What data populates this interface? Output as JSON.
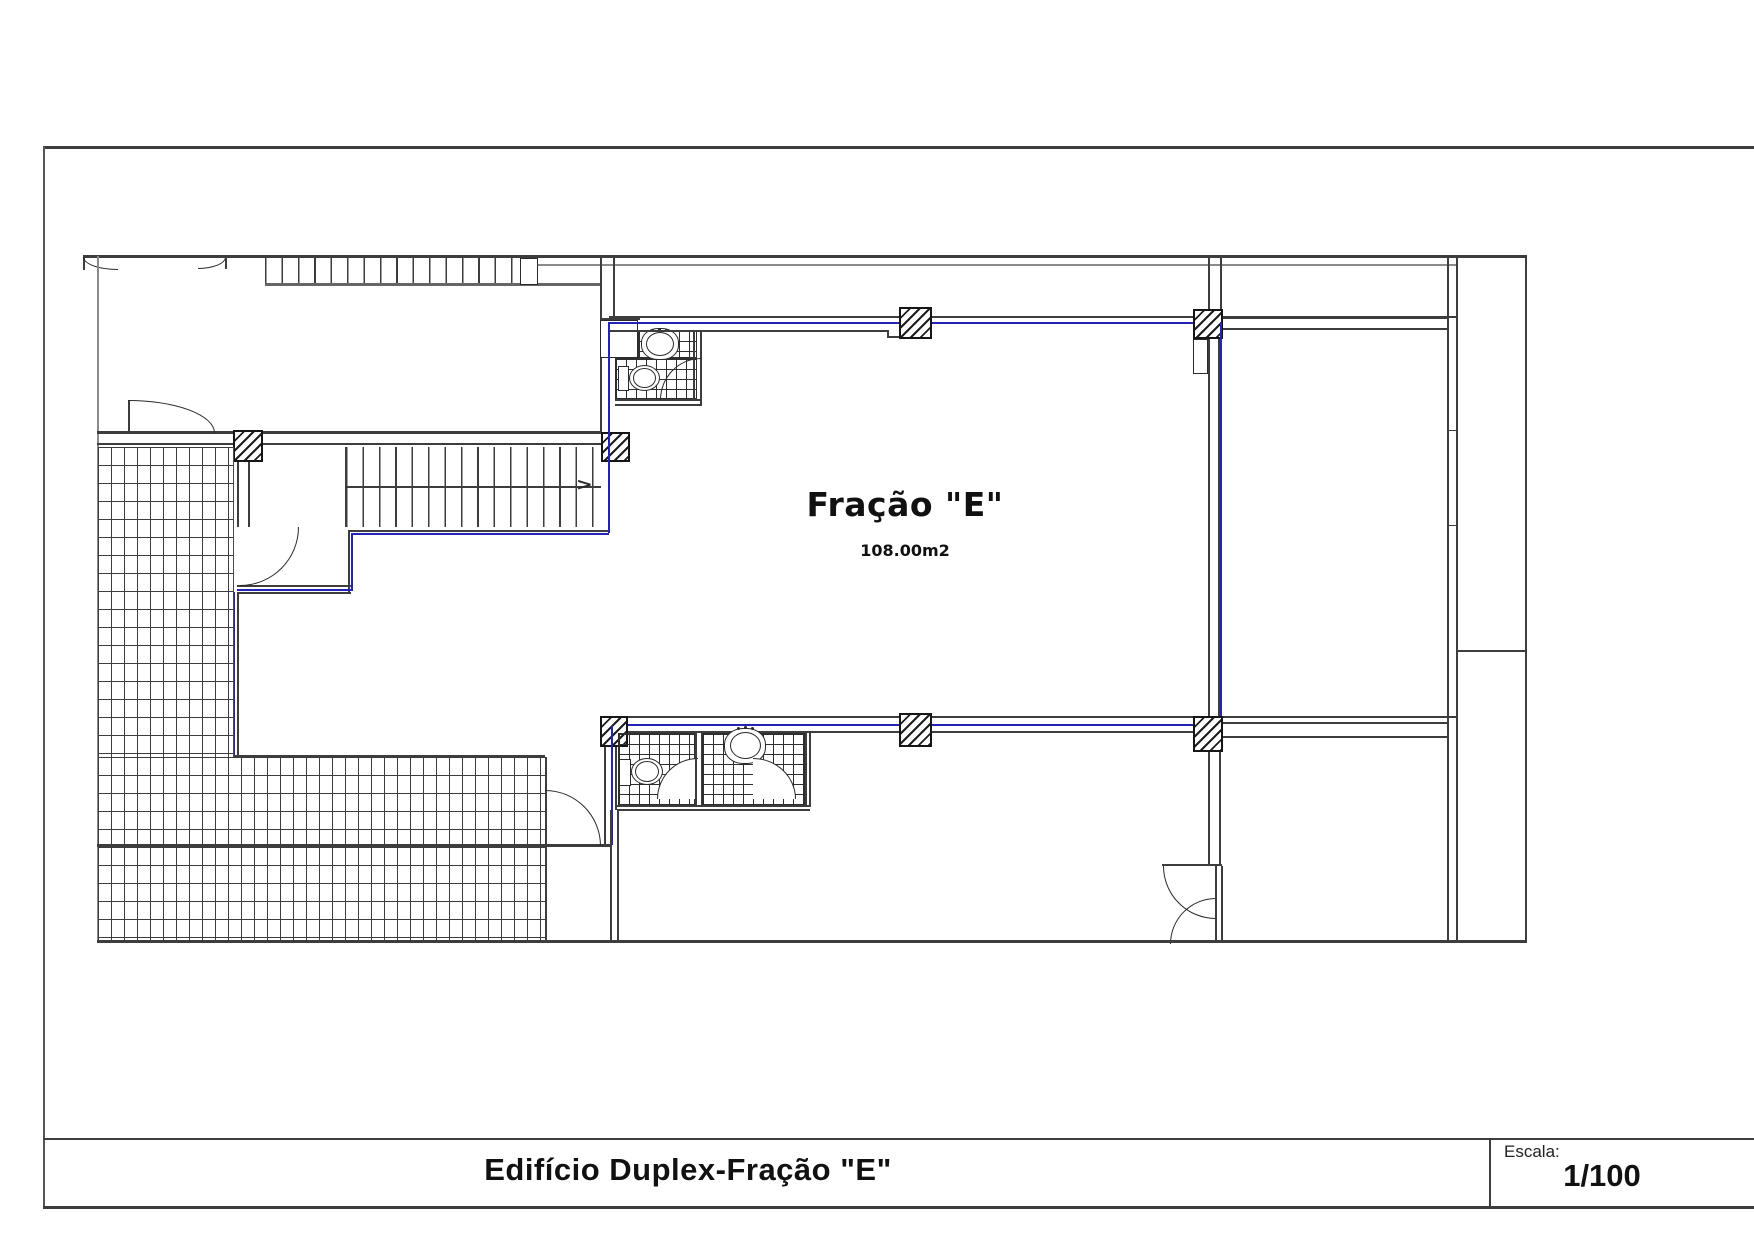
{
  "drawing": {
    "room_label": "Fração \"E\"",
    "room_area": "108.00m2",
    "stair_arrow_glyph": ">"
  },
  "title_block": {
    "title": "Edifício Duplex-Fração \"E\"",
    "scale_label": "Escala:",
    "scale_value": "1/100"
  },
  "colors": {
    "accent_blue": "#2323b8",
    "wall_dark": "#3d3d3d",
    "wall_light": "#8a8a8a"
  }
}
